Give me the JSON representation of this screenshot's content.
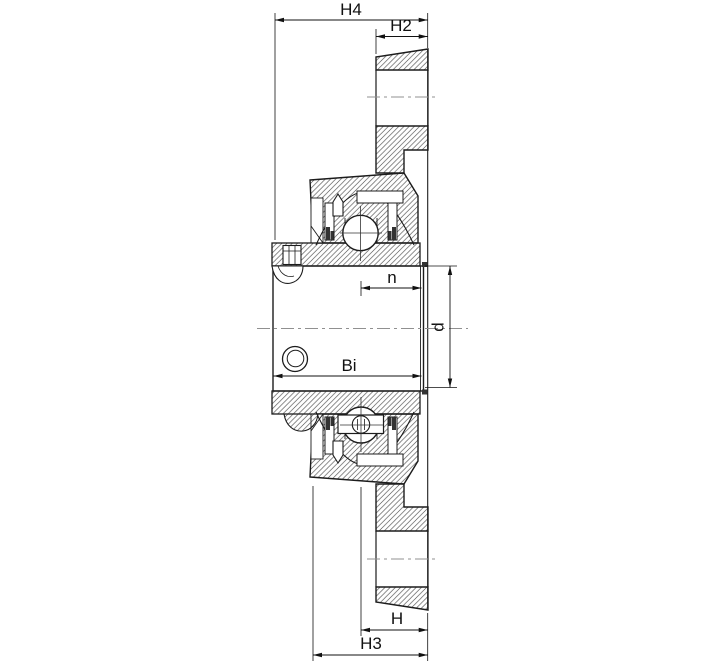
{
  "drawing": {
    "dimension_labels": {
      "h4": "H4",
      "h2": "H2",
      "n": "n",
      "d": "d",
      "bi": "Bi",
      "h": "H",
      "h3": "H3"
    }
  },
  "colors": {
    "outline": "#1c1c1c",
    "hatch": "#4a4a4a",
    "centerline": "#909090",
    "dimension": "#111111",
    "background": "#ffffff"
  }
}
